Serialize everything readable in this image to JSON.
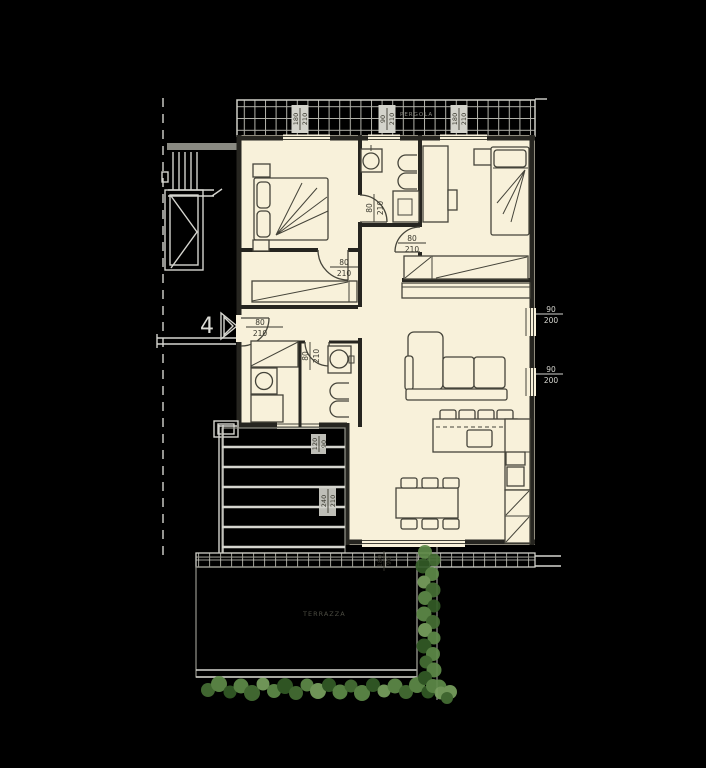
{
  "title": "apartment-floor-plan",
  "unit": {
    "number": "4"
  },
  "area_labels": {
    "terrace": "TERRAZZA",
    "pergola": "PERGOLA"
  },
  "dims": [
    {
      "w": "80",
      "h": "210"
    },
    {
      "w": "80",
      "h": "210"
    },
    {
      "w": "80",
      "h": "210"
    },
    {
      "w": "80",
      "h": "210"
    },
    {
      "w": "80",
      "h": "210"
    },
    {
      "w": "180",
      "h": "210"
    },
    {
      "w": "90",
      "h": "210"
    },
    {
      "w": "180",
      "h": "210"
    },
    {
      "w": "90",
      "h": "200"
    },
    {
      "w": "90",
      "h": "200"
    },
    {
      "w": "240",
      "h": "210"
    },
    {
      "w": "180",
      "h": "90"
    },
    {
      "w": "120",
      "h": "90"
    }
  ],
  "colors": {
    "background": "#000000",
    "floor": "#f8f1da",
    "wall": "#262520",
    "outside_lines": "#d5d5cf",
    "terrace_grid": "#94948c",
    "plants": "#5f8b49"
  }
}
